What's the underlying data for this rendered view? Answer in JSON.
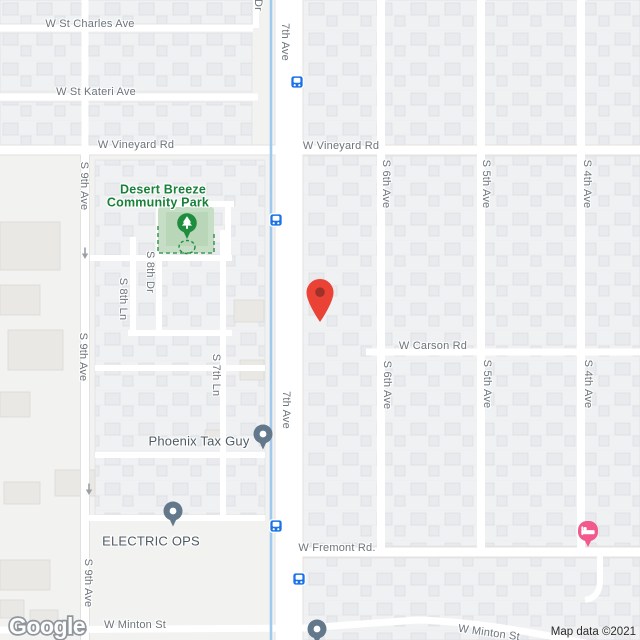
{
  "map": {
    "provider_logo": "Google",
    "attribution": "Map data ©2021",
    "colors": {
      "canal_blue": "#9fc9ee",
      "transit_blue": "#1a73e8",
      "marker_red": "#ea4335",
      "marker_red_dark": "#9e322a",
      "poi_pin_gray": "#64788c",
      "lodging_pink": "#f2598c",
      "park_fill": "#c6dec5",
      "park_fill_inner": "#b9d6b9",
      "park_pin_green": "#1e8e3e",
      "park_dash_green": "#419b5a",
      "park_text_green": "#188038",
      "oneway_gray": "#9aa0a6"
    },
    "streets": {
      "horizontal": [
        {
          "text": "W St Charles Ave"
        },
        {
          "text": "W St Kateri Ave"
        },
        {
          "text": "W Vineyard Rd"
        },
        {
          "text": "W Vineyard Rd"
        },
        {
          "text": "W Carson Rd"
        },
        {
          "text": "W Fremont Rd."
        },
        {
          "text": "W Minton St"
        },
        {
          "text": "W Minton St"
        }
      ],
      "vertical": [
        {
          "text": "7th Ave"
        },
        {
          "text": "7th Ave"
        },
        {
          "text": "S 9th Ave"
        },
        {
          "text": "S 9th Ave"
        },
        {
          "text": "S 9th Ave"
        },
        {
          "text": "S 8th Dr"
        },
        {
          "text": "S 8th Ln"
        },
        {
          "text": "S 7th Ln"
        },
        {
          "text": "S 6th Ave"
        },
        {
          "text": "S 6th Ave"
        },
        {
          "text": "S 5th Ave"
        },
        {
          "text": "S 5th Ave"
        },
        {
          "text": "S 4th Ave"
        },
        {
          "text": "S 4th Ave"
        },
        {
          "text": "Dr"
        },
        {
          "text": "Ave"
        },
        {
          "text": "Ave"
        },
        {
          "text": "Ave"
        }
      ]
    },
    "places": {
      "park": {
        "name": "Desert Breeze Community Park",
        "line1": "Desert Breeze",
        "line2": "Community Park"
      },
      "tax_office": {
        "name": "Phoenix Tax Guy"
      },
      "electric": {
        "name": "ELECTRIC OPS"
      }
    },
    "markers": {
      "destination": {
        "type": "red-place-marker"
      },
      "lodging": {
        "type": "hotel-pin"
      },
      "transit_stops": [
        {
          "type": "bus-stop"
        },
        {
          "type": "bus-stop"
        },
        {
          "type": "bus-stop"
        },
        {
          "type": "bus-stop"
        }
      ]
    }
  }
}
